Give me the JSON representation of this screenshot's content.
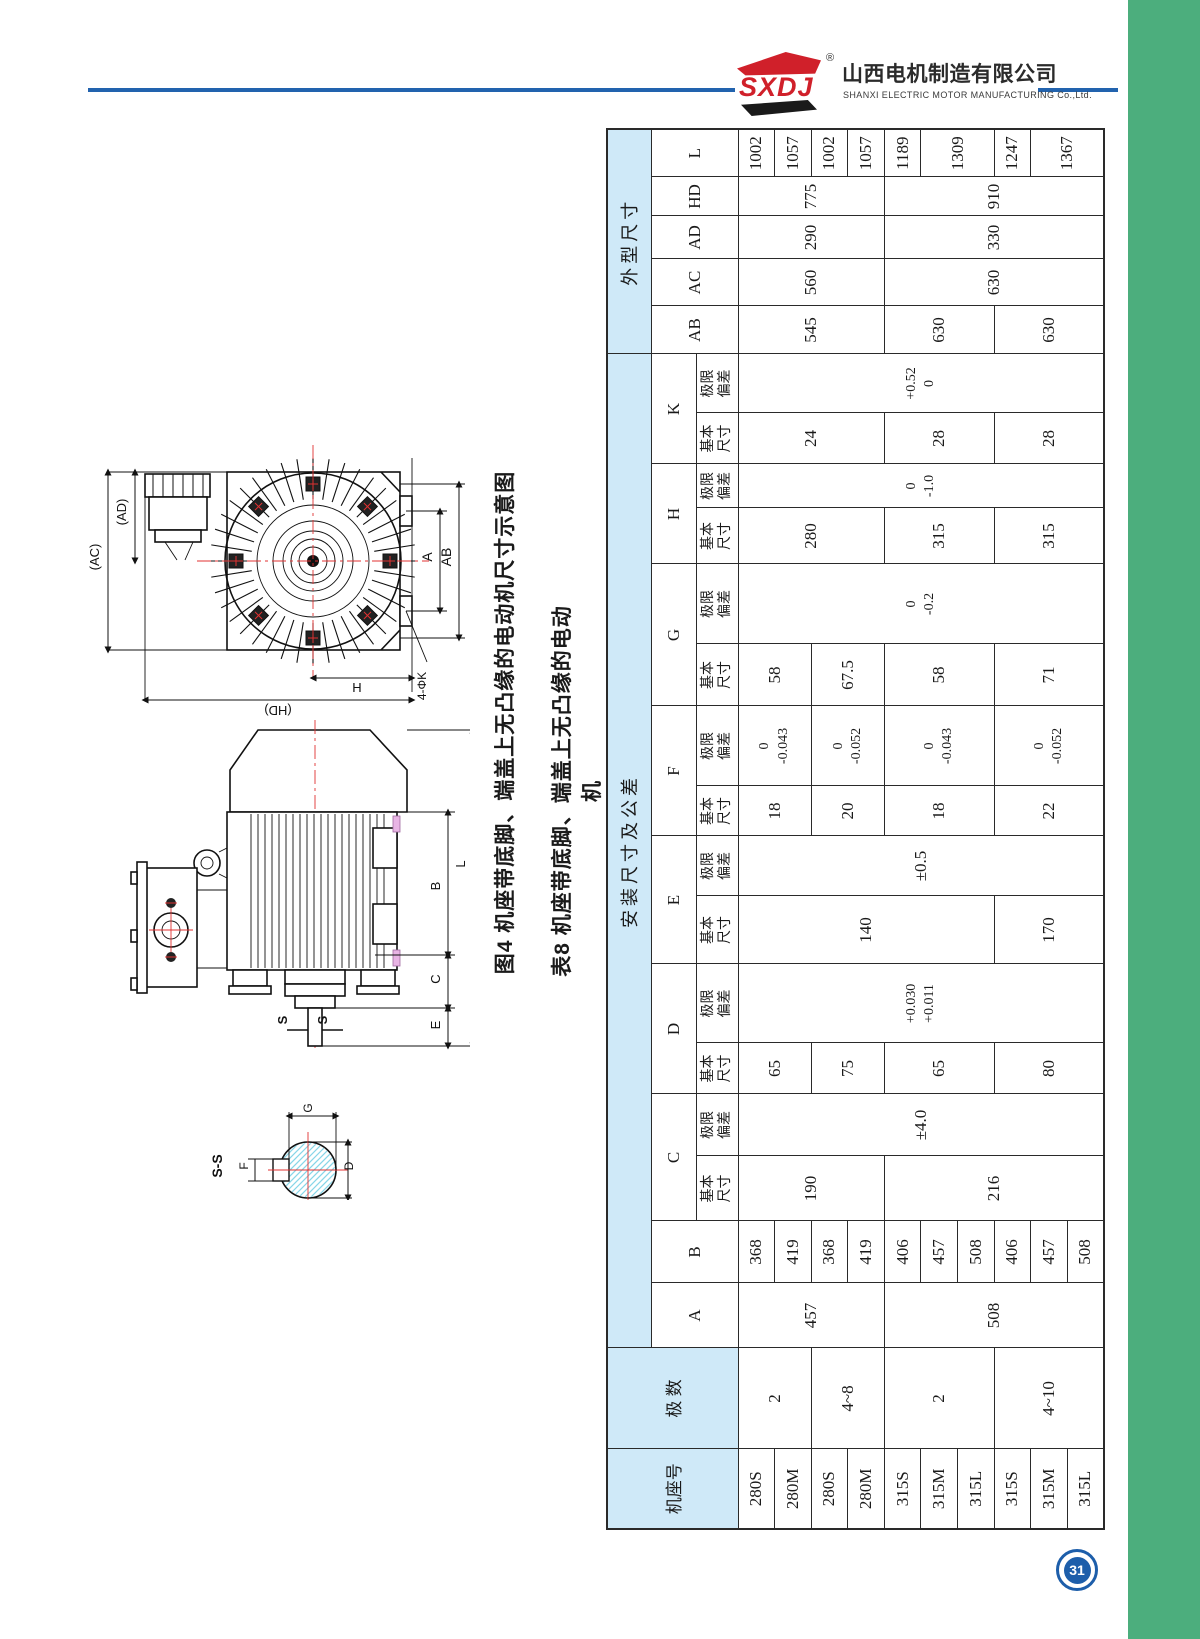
{
  "brand": {
    "logo_text": "SXDJ",
    "registered": "®",
    "company_cn": "山西电机制造有限公司",
    "company_en": "SHANXI ELECTRIC MOTOR MANUFACTURING Co.,Ltd."
  },
  "figure": {
    "caption_figure": "图4 机座带底脚、端盖上无凸缘的电动机尺寸示意图",
    "caption_table": "表8 机座带底脚、端盖上无凸缘的电动机",
    "fig1_labels": {
      "ac": "(AC)",
      "ad": "(AD)",
      "a": "A",
      "ab": "AB",
      "h": "H",
      "holes": "4-ΦK",
      "hd": "(HD)"
    },
    "fig2_labels": {
      "b": "B",
      "c": "C",
      "e": "E",
      "l": "L",
      "s1": "S",
      "s2": "S"
    },
    "fig3_labels": {
      "title": "S-S",
      "g": "G",
      "d": "D",
      "f": "F"
    }
  },
  "table": {
    "header": {
      "frame": "机座号",
      "poles": "极 数",
      "install_group": "安装尺寸及公差",
      "outline_group": "外型尺寸",
      "basic": "基本\n尺寸",
      "deviation": "极限\n偏差",
      "dims": [
        "A",
        "B",
        "C",
        "D",
        "E",
        "F",
        "G",
        "H",
        "K"
      ],
      "dims_with_sub": [
        "C",
        "D",
        "E",
        "F",
        "G",
        "H",
        "K"
      ],
      "outline_dims": [
        "AB",
        "AC",
        "AD",
        "HD",
        "L"
      ]
    },
    "columns": [
      {
        "key": "frame",
        "cells": [
          {
            "v": "280S"
          },
          {
            "v": "280M"
          },
          {
            "v": "280S"
          },
          {
            "v": "280M"
          },
          {
            "v": "315S"
          },
          {
            "v": "315M"
          },
          {
            "v": "315L"
          },
          {
            "v": "315S"
          },
          {
            "v": "315M"
          },
          {
            "v": "315L"
          }
        ]
      },
      {
        "key": "poles",
        "cells": [
          {
            "v": "2",
            "s": 2
          },
          {
            "v": "4~8",
            "s": 2
          },
          {
            "v": "2",
            "s": 3
          },
          {
            "v": "4~10",
            "s": 3
          }
        ]
      },
      {
        "key": "A",
        "cells": [
          {
            "v": "457",
            "s": 4
          },
          {
            "v": "508",
            "s": 6
          }
        ]
      },
      {
        "key": "B",
        "cells": [
          {
            "v": "368"
          },
          {
            "v": "419"
          },
          {
            "v": "368"
          },
          {
            "v": "419"
          },
          {
            "v": "406"
          },
          {
            "v": "457"
          },
          {
            "v": "508"
          },
          {
            "v": "406"
          },
          {
            "v": "457"
          },
          {
            "v": "508"
          }
        ]
      },
      {
        "key": "C-basic",
        "cells": [
          {
            "v": "190",
            "s": 4
          },
          {
            "v": "216",
            "s": 6
          }
        ]
      },
      {
        "key": "C-dev",
        "cells": [
          {
            "v": "±4.0",
            "s": 10
          }
        ]
      },
      {
        "key": "D-basic",
        "cells": [
          {
            "v": "65",
            "s": 2
          },
          {
            "v": "75",
            "s": 2
          },
          {
            "v": "65",
            "s": 3
          },
          {
            "v": "80",
            "s": 3
          }
        ]
      },
      {
        "key": "D-dev",
        "cells": [
          {
            "v": "+0.030\n+0.011",
            "s": 10
          }
        ]
      },
      {
        "key": "E-basic",
        "cells": [
          {
            "v": "140",
            "s": 7
          },
          {
            "v": "170",
            "s": 3
          }
        ]
      },
      {
        "key": "E-dev",
        "cells": [
          {
            "v": "±0.5",
            "s": 10
          }
        ]
      },
      {
        "key": "F-basic",
        "cells": [
          {
            "v": "18",
            "s": 2
          },
          {
            "v": "20",
            "s": 2
          },
          {
            "v": "18",
            "s": 3
          },
          {
            "v": "22",
            "s": 3
          }
        ]
      },
      {
        "key": "F-dev",
        "cells": [
          {
            "v": "0\n-0.043",
            "s": 2
          },
          {
            "v": "0\n-0.052",
            "s": 2
          },
          {
            "v": "0\n-0.043",
            "s": 3
          },
          {
            "v": "0\n-0.052",
            "s": 3
          }
        ]
      },
      {
        "key": "G-basic",
        "cells": [
          {
            "v": "58",
            "s": 2
          },
          {
            "v": "67.5",
            "s": 2
          },
          {
            "v": "58",
            "s": 3
          },
          {
            "v": "71",
            "s": 3
          }
        ]
      },
      {
        "key": "G-dev",
        "cells": [
          {
            "v": "0\n-0.2",
            "s": 10
          }
        ]
      },
      {
        "key": "H-basic",
        "cells": [
          {
            "v": "280",
            "s": 4
          },
          {
            "v": "315",
            "s": 3
          },
          {
            "v": "315",
            "s": 3
          }
        ]
      },
      {
        "key": "H-dev",
        "cells": [
          {
            "v": "0\n-1.0",
            "s": 10
          }
        ]
      },
      {
        "key": "K-basic",
        "cells": [
          {
            "v": "24",
            "s": 4
          },
          {
            "v": "28",
            "s": 3
          },
          {
            "v": "28",
            "s": 3
          }
        ]
      },
      {
        "key": "K-dev",
        "cells": [
          {
            "v": "+0.52\n0",
            "s": 10
          }
        ]
      },
      {
        "key": "AB",
        "cells": [
          {
            "v": "545",
            "s": 4
          },
          {
            "v": "630",
            "s": 3
          },
          {
            "v": "630",
            "s": 3
          }
        ]
      },
      {
        "key": "AC",
        "cells": [
          {
            "v": "560",
            "s": 4
          },
          {
            "v": "630",
            "s": 6
          }
        ]
      },
      {
        "key": "AD",
        "cells": [
          {
            "v": "290",
            "s": 4
          },
          {
            "v": "330",
            "s": 6
          }
        ]
      },
      {
        "key": "HD",
        "cells": [
          {
            "v": "775",
            "s": 4
          },
          {
            "v": "910",
            "s": 6
          }
        ]
      },
      {
        "key": "L",
        "cells": [
          {
            "v": "1002"
          },
          {
            "v": "1057"
          },
          {
            "v": "1002"
          },
          {
            "v": "1057"
          },
          {
            "v": "1189"
          },
          {
            "v": "1309",
            "s": 2
          },
          {
            "v": "1247"
          },
          {
            "v": "1367",
            "s": 2
          }
        ]
      }
    ]
  },
  "page_number": "31",
  "colors": {
    "green_band": "#4cae7d",
    "blue_rule": "#2263ae",
    "logo_red": "#d0202a",
    "header_blue": "#cfe9f8",
    "badge_blue": "#1d5eaa",
    "hatch_cyan": "#86d5e8",
    "centerline_red": "#e03131"
  }
}
